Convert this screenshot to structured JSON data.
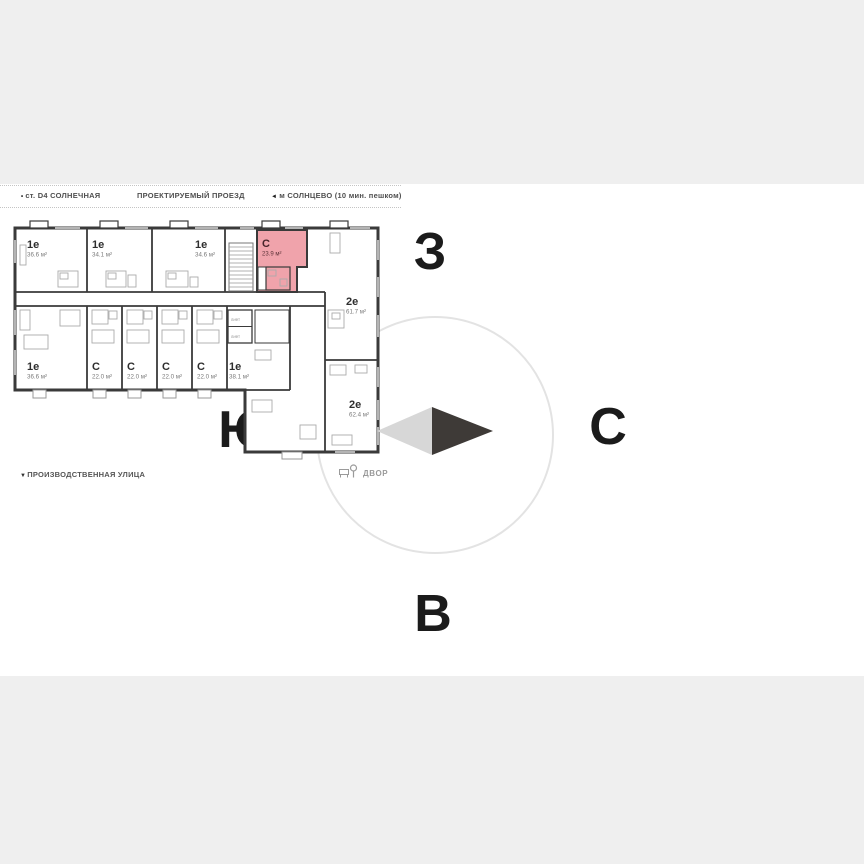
{
  "header": {
    "station": {
      "marker": "•",
      "label": "ст. D4 СОЛНЕЧНАЯ"
    },
    "road": {
      "label": "ПРОЕКТИРУЕМЫЙ ПРОЕЗД"
    },
    "metro": {
      "marker": "◄",
      "label": "м СОЛНЦЕВО (10 мин. пешком)"
    }
  },
  "streets": {
    "bottom": {
      "marker": "▼",
      "label": "ПРОИЗВОДСТВЕННАЯ УЛИЦА"
    }
  },
  "compass": {
    "west": "З",
    "south": "Ю",
    "north": "С",
    "east": "В"
  },
  "courtyard": {
    "label": "ДВОР"
  },
  "plan": {
    "lift_label": "ЛИФТ",
    "apartments": {
      "top": [
        {
          "type": "1е",
          "area": "36.6 м²"
        },
        {
          "type": "1е",
          "area": "34.1 м²"
        },
        {
          "type": "1е",
          "area": "34.6 м²"
        },
        {
          "type": "С",
          "area": "23.9 м²",
          "highlighted": true
        }
      ],
      "right": [
        {
          "type": "2е",
          "area": "61.7 м²"
        },
        {
          "type": "2е",
          "area": "62.4 м²"
        }
      ],
      "bottom": [
        {
          "type": "1е",
          "area": "36.6 м²"
        },
        {
          "type": "С",
          "area": "22.0 м²"
        },
        {
          "type": "С",
          "area": "22.0 м²"
        },
        {
          "type": "С",
          "area": "22.0 м²"
        },
        {
          "type": "С",
          "area": "22.0 м²"
        },
        {
          "type": "1е",
          "area": "38.1 м²"
        }
      ]
    }
  },
  "colors": {
    "background": "#efefef",
    "canvas": "#ffffff",
    "wall": "#3a3a3a",
    "highlight": "#f0a3ab",
    "highlight_text": "#47232a",
    "compass_dark": "#3e3a37",
    "compass_light": "#d7d7d7"
  }
}
